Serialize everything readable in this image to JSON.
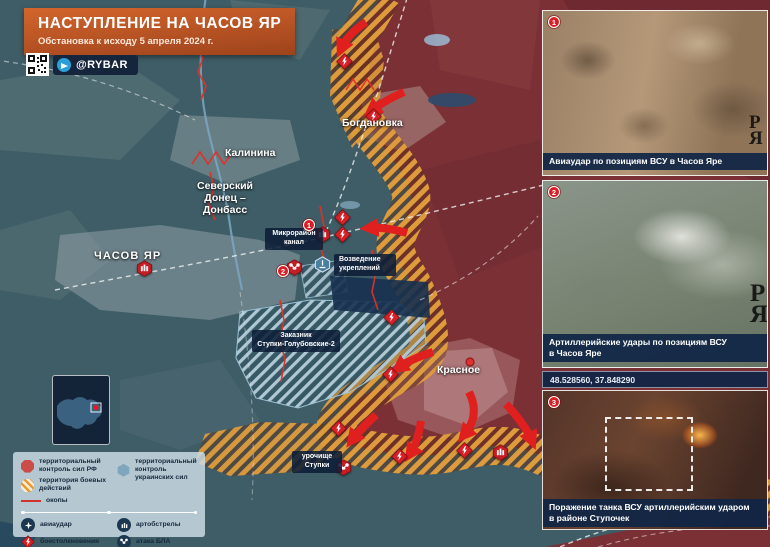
{
  "header": {
    "title": "НАСТУПЛЕНИЕ НА ЧАСОВ ЯР",
    "subtitle": "Обстановка к исходу 5 апреля 2024 г.",
    "channel": "@RYBAR"
  },
  "map": {
    "labels": {
      "kalinina": "Калинина",
      "canal": "Северский\nДонец –\nДонбасс",
      "bogdanovka": "Богдановка",
      "chasov_yar": "ЧАСОВ ЯР",
      "mikroraion": "Микрорайон\nканал",
      "vozvedenie": "Возведение\nукреплений",
      "zakaznik": "Заказник\nСтупки-Голубовские-2",
      "krasnoe": "Красное",
      "urochishche": "урочище\nСтупки"
    },
    "markers": {
      "m1": "1",
      "m2": "2"
    }
  },
  "legend": {
    "items": [
      {
        "label": "территориальный контроль сил РФ"
      },
      {
        "label": "территория боевых действий"
      },
      {
        "label": "окопы"
      },
      {
        "label": "территориальный контроль украинских сил"
      },
      {
        "label": "авиаудар"
      },
      {
        "label": "артобстрелы"
      },
      {
        "label": "боестолкновения"
      },
      {
        "label": "атака БЛА"
      }
    ]
  },
  "panels": {
    "items": [
      {
        "number": "1",
        "caption": "Авиаудар по позициям ВСУ в Часов Яре",
        "watermark": "РЯ"
      },
      {
        "number": "2",
        "caption": "Артиллерийские удары по позициям ВСУ\nв Часов Яре",
        "watermark": "РЯ"
      },
      {
        "number": "3",
        "caption": "Поражение танка ВСУ артиллерийским ударом\nв районе Ступочек"
      }
    ],
    "coordinates": "48.528560, 37.848290"
  },
  "colors": {
    "rf_control": "#7b3036",
    "ua_control": "#3f5d66",
    "combat_zone": "#dd9b3b",
    "accent_red": "#d81f26",
    "caption_bg": "#102646",
    "title_bg": "#c05a26"
  }
}
